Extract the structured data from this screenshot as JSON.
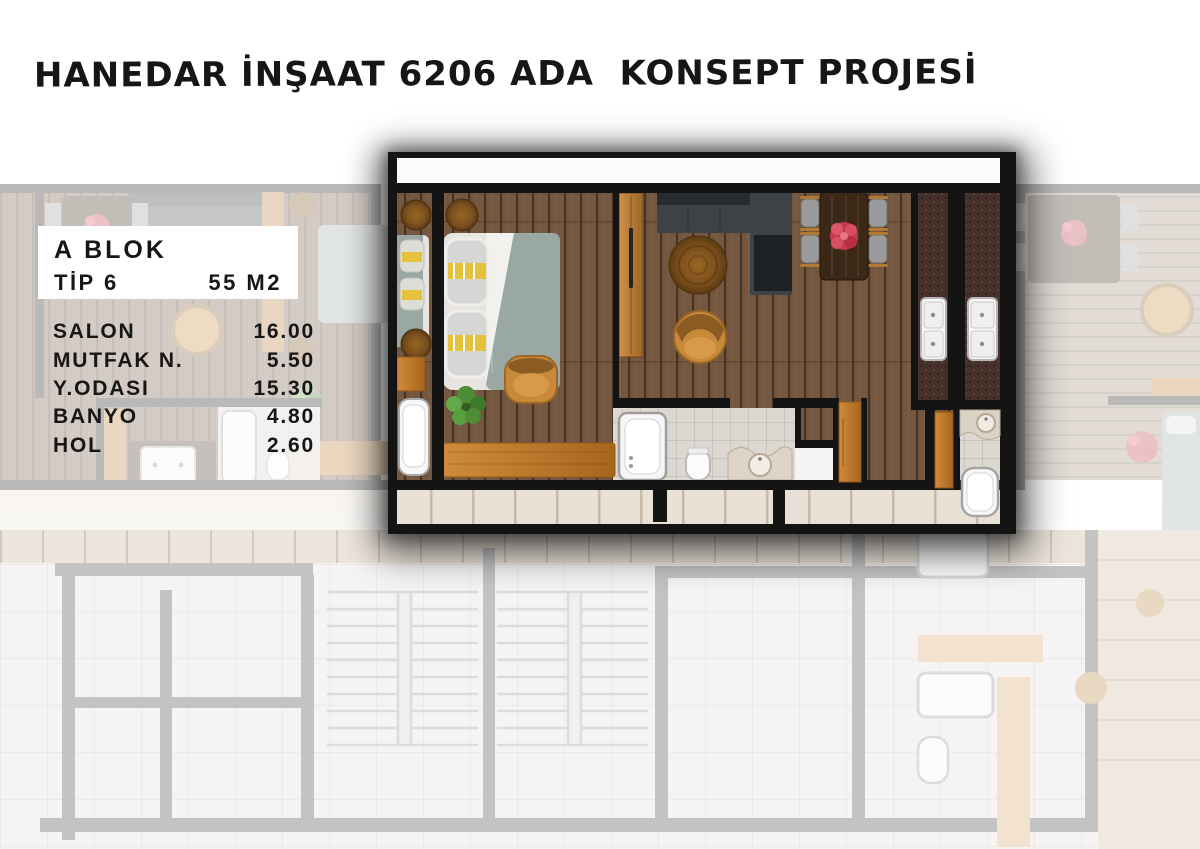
{
  "title": "HANEDAR İNŞAAT 6206 ADA  KONSEPT PROJESİ",
  "info_box": {
    "block": "A BLOK",
    "type": "TİP 6",
    "area": "55 M2"
  },
  "rooms": [
    {
      "name": "SALON",
      "area": "16.00"
    },
    {
      "name": "MUTFAK N.",
      "area": "5.50"
    },
    {
      "name": "Y.ODASI",
      "area": "15.30"
    },
    {
      "name": "BANYO",
      "area": "4.80"
    },
    {
      "name": "HOL",
      "area": "2.60"
    }
  ],
  "colors": {
    "page_bg": "#ffffff",
    "text_dark": "#161616",
    "info_box_bg": "#ffffff",
    "wall_black": "#141414",
    "wood_floor": "#75563e",
    "kitchen_counter": "#46302a",
    "accent_orange": "#c07a2d",
    "sofa_gray": "#3f4346",
    "bed_gray": "#9aa8a4",
    "flower_red": "#d94f62",
    "bath_tile": "#dcd7d1",
    "corridor_beige": "#e9e1d6",
    "faded_wall_gray": "#c3c3c3"
  }
}
